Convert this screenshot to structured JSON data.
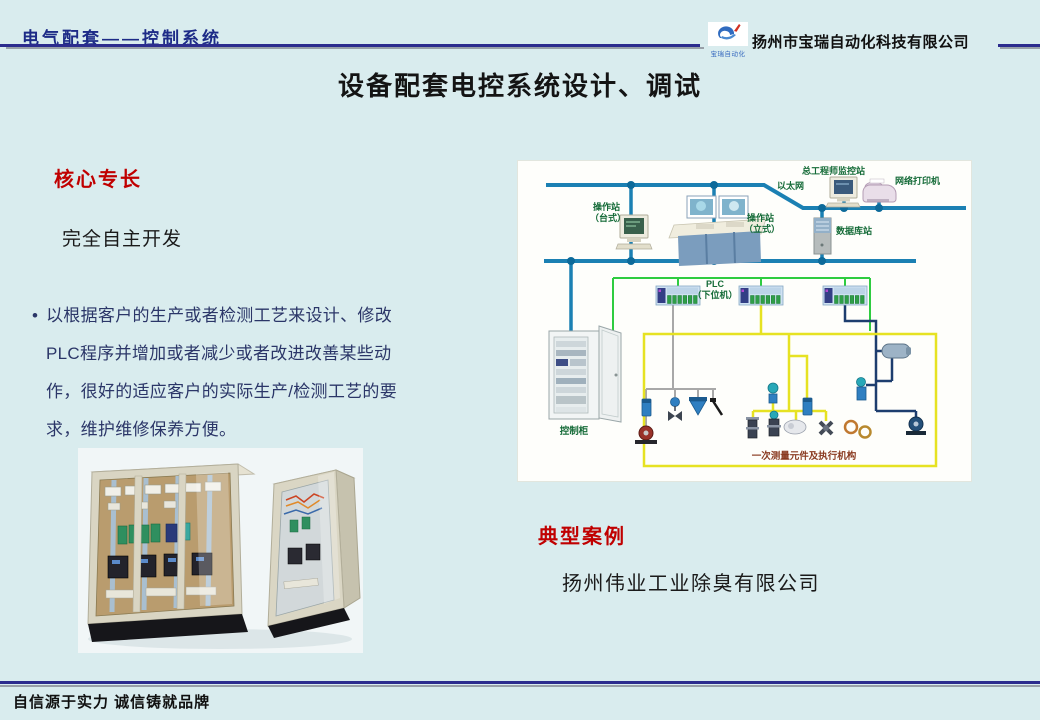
{
  "slide": {
    "header": {
      "section_title": "电气配套——控制系统",
      "company_name": "扬州市宝瑞自动化科技有限公司",
      "logo_caption": "宝瑞自动化"
    },
    "title": "设备配套电控系统设计、调试",
    "core": {
      "heading": "核心专长",
      "subheading": "完全自主开发",
      "bullet_marker": "•",
      "bullet": "以根据客户的生产或者检测工艺来设计、修改PLC程序并增加或者减少或者改进改善某些动作，很好的适应客户的实际生产/检测工艺的要求，维护维修保养方便。"
    },
    "case": {
      "heading": "典型案例",
      "company": "扬州伟业工业除臭有限公司"
    },
    "footer": {
      "slogan": "自信源于实力 诚信铸就品牌"
    }
  },
  "diagram": {
    "labels": {
      "ethernet": "以太网",
      "op_desk_1": "操作站",
      "op_desk_2": "（台式）",
      "op_stand_1": "操作站",
      "op_stand_2": "（立式）",
      "engineer_station": "总工程师监控站",
      "printer": "网络打印机",
      "database": "数据库站",
      "plc_1": "PLC",
      "plc_2": "（下位机）",
      "cabinet": "控制柜",
      "field": "一次测量元件及执行机构"
    },
    "colors": {
      "bus": "#1b80b3",
      "node": "#0d6a9a",
      "green_bus": "#2ecc40",
      "yellow_bus": "#e6e222",
      "navy_bus": "#1d3d6e",
      "gray_bus": "#a8a8a8",
      "label_green": "#156b38",
      "label_red": "#8a3a20"
    }
  },
  "theme": {
    "background": "#d9ecee",
    "accent_navy": "#1d2b87",
    "accent_red": "#c00000",
    "body_navy": "#2b3668"
  }
}
